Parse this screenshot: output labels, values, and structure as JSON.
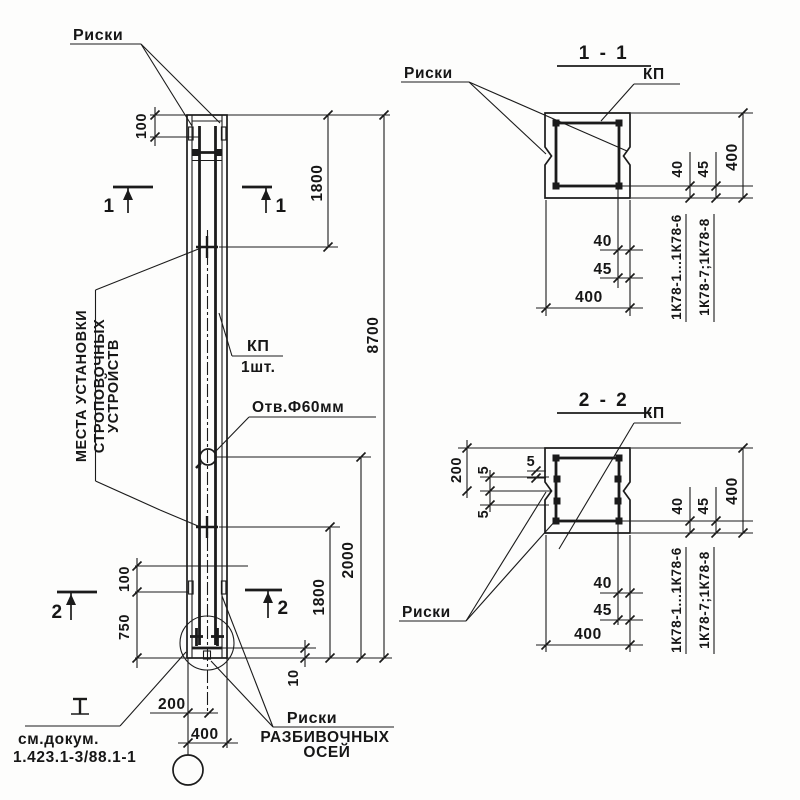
{
  "drawing": {
    "paper_color": "#fdfdfc",
    "ink_color": "#1b1b1b",
    "labels": {
      "riski": "Риски",
      "kp": "КП",
      "kp_qty": "1шт.",
      "hole": "Отв.Ф60мм",
      "strop_line1": "МЕСТА УСТАНОВКИ",
      "strop_line2": "СТРОПОВОЧНЫХ",
      "strop_line3": "УСТРОЙСТВ",
      "axes_line1": "Риски",
      "axes_line2": "РАЗБИВОЧНЫХ",
      "axes_line3": "ОСЕЙ",
      "doc_line1": "см.докум.",
      "doc_line2": "1.423.1-3/88.1-1",
      "series_a": "1К78-1...1К78-6",
      "series_b": "1К78-7;1К78-8"
    },
    "sections": {
      "s1_title": "1 - 1",
      "s2_title": "2 - 2",
      "mark1": "1",
      "mark2": "2"
    },
    "dims": {
      "d5": "5",
      "d10": "10",
      "d40": "40",
      "d45": "45",
      "d100": "100",
      "d200": "200",
      "d400": "400",
      "d750": "750",
      "d1800": "1800",
      "d2000": "2000",
      "d8700": "8700"
    }
  }
}
